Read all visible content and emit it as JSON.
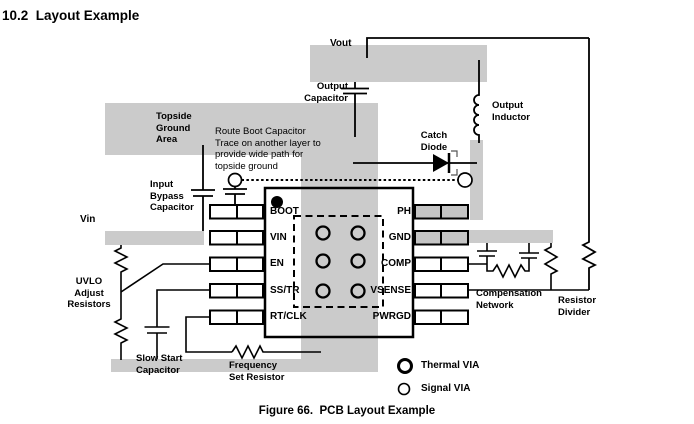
{
  "title": "10.2  Layout Example",
  "figure_caption": "Figure 66.  PCB Layout Example",
  "colors": {
    "trace_gray": "#cbcbcb",
    "pad_gray": "#c4c4c4",
    "line": "#000000",
    "text": "#000000"
  },
  "ic": {
    "pins_left": [
      "BOOT",
      "VIN",
      "EN",
      "SS/TR",
      "RT/CLK"
    ],
    "pins_right": [
      "PH",
      "GND",
      "COMP",
      "VSENSE",
      "PWRGD"
    ]
  },
  "labels": {
    "vout": "Vout",
    "output_capacitor": "Output\nCapacitor",
    "output_inductor": "Output\nInductor",
    "catch_diode": "Catch\nDiode",
    "topside_ground_area": "Topside\nGround\nArea",
    "route_boot_note": "Route Boot Capacitor\nTrace on another layer to\nprovide wide path for\ntopside ground",
    "input_bypass_capacitor": "Input\nBypass\nCapacitor",
    "vin": "Vin",
    "uvlo_adjust_resistors": "UVLO\nAdjust\nResistors",
    "slow_start_capacitor": "Slow Start\nCapacitor",
    "frequency_set_resistor": "Frequency\nSet Resistor",
    "compensation_network": "Compensation\nNetwork",
    "resistor_divider": "Resistor\nDivider"
  },
  "legend": {
    "thermal_via": "Thermal VIA",
    "signal_via": "Signal VIA"
  }
}
